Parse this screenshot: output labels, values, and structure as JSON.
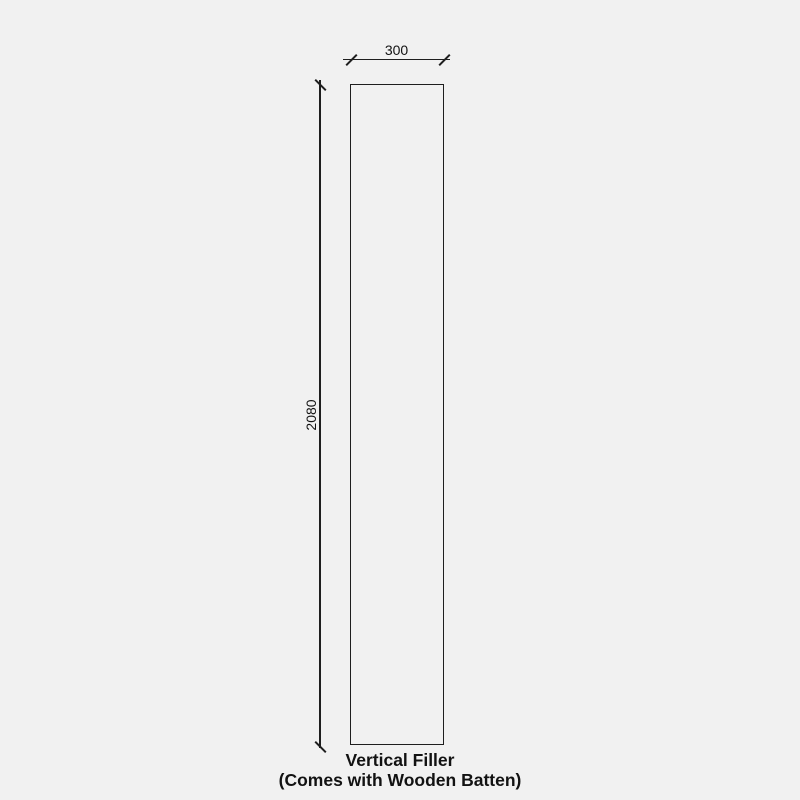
{
  "drawing": {
    "background_color": "#f1f1f1",
    "line_color": "#1e1e1e",
    "text_color": "#121212",
    "dimensions": {
      "width": "300",
      "height": "2080"
    },
    "caption": {
      "line1": "Vertical Filler",
      "line2": "(Comes with Wooden Batten)"
    }
  }
}
